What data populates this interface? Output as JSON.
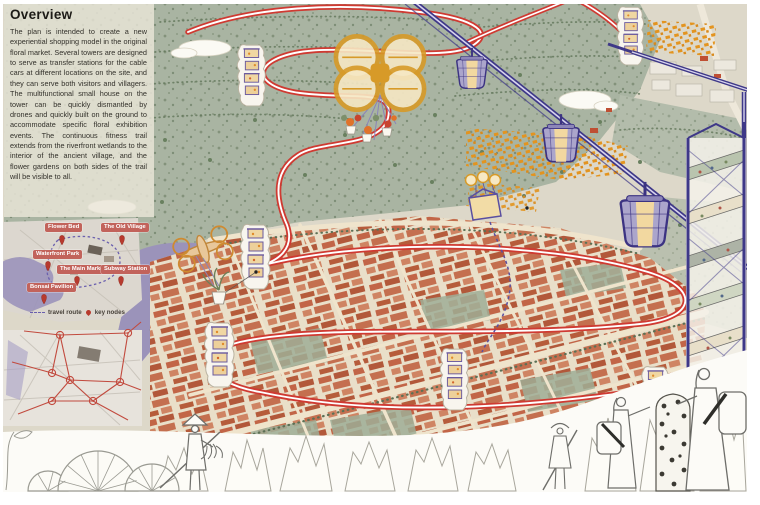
{
  "overview": {
    "title": "Overview",
    "body": "The plan is intended to create a new experiential shopping model in the original floral market. Several towers are designed to serve as transfer stations for the cable cars at different locations on the site, and they can serve both visitors and villagers. The multifunctional small house on the tower can be quickly dismantled by drones and quickly built on the ground to accommodate specific floral exhibition events. The continuous fitness trail extends from the riverfront wetlands to the interior of the ancient village, and the flower gardens on both sides of the trail will be visible to all."
  },
  "context_map": {
    "labels": [
      "Flower Bed",
      "The Old Village",
      "Waterfront Park",
      "The Main Market",
      "Subway Station",
      "Bonsai Pavilion"
    ],
    "legend": {
      "route": "travel route",
      "nodes": "key nodes"
    }
  },
  "colors": {
    "trail_red": "#d23c36",
    "cable_indigo": "#3e3888",
    "water_purple": "#9b93ba",
    "roof_terracotta": "#bf5a3c",
    "flower_orange": "#e3941f",
    "label_badge": "#c2635b",
    "map_green": "#a9b4a2"
  }
}
